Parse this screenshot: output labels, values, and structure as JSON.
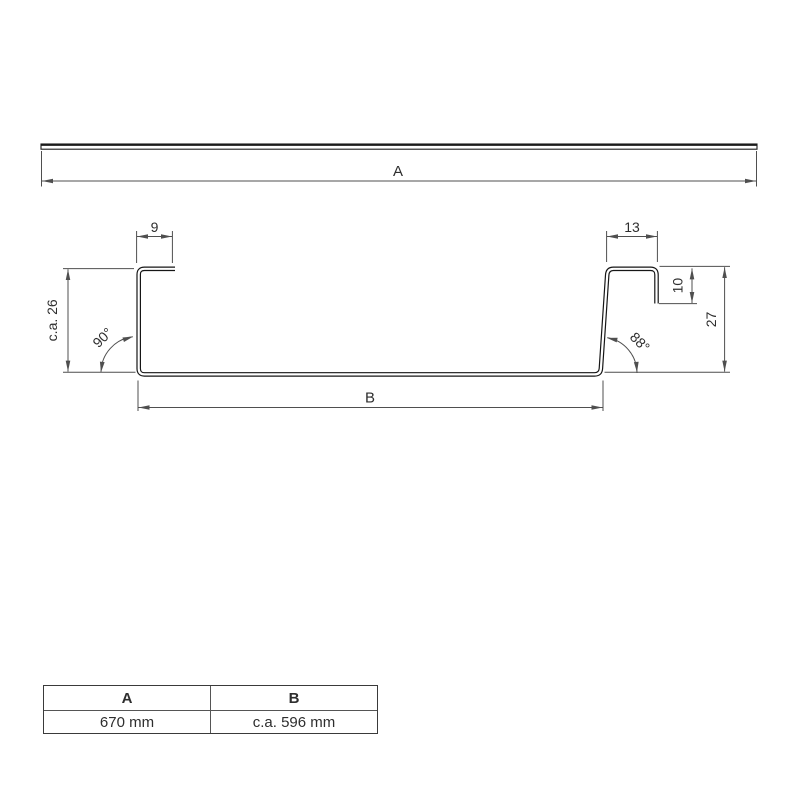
{
  "title": "Sheet metal profile technical drawing",
  "dims": {
    "a_label": "A",
    "b_label": "B",
    "flange_left_width": "9",
    "flange_right_width": "13",
    "hook_depth": "10",
    "right_height": "27",
    "left_height": "c.a. 26",
    "angle_left": "90°",
    "angle_right": "88°"
  },
  "table": {
    "headers": [
      "A",
      "B"
    ],
    "values": [
      "670 mm",
      "c.a. 596 mm"
    ]
  },
  "colors": {
    "dimension_line": "#4f4f4f",
    "profile_line": "#161616",
    "text": "#2e2e2e"
  }
}
